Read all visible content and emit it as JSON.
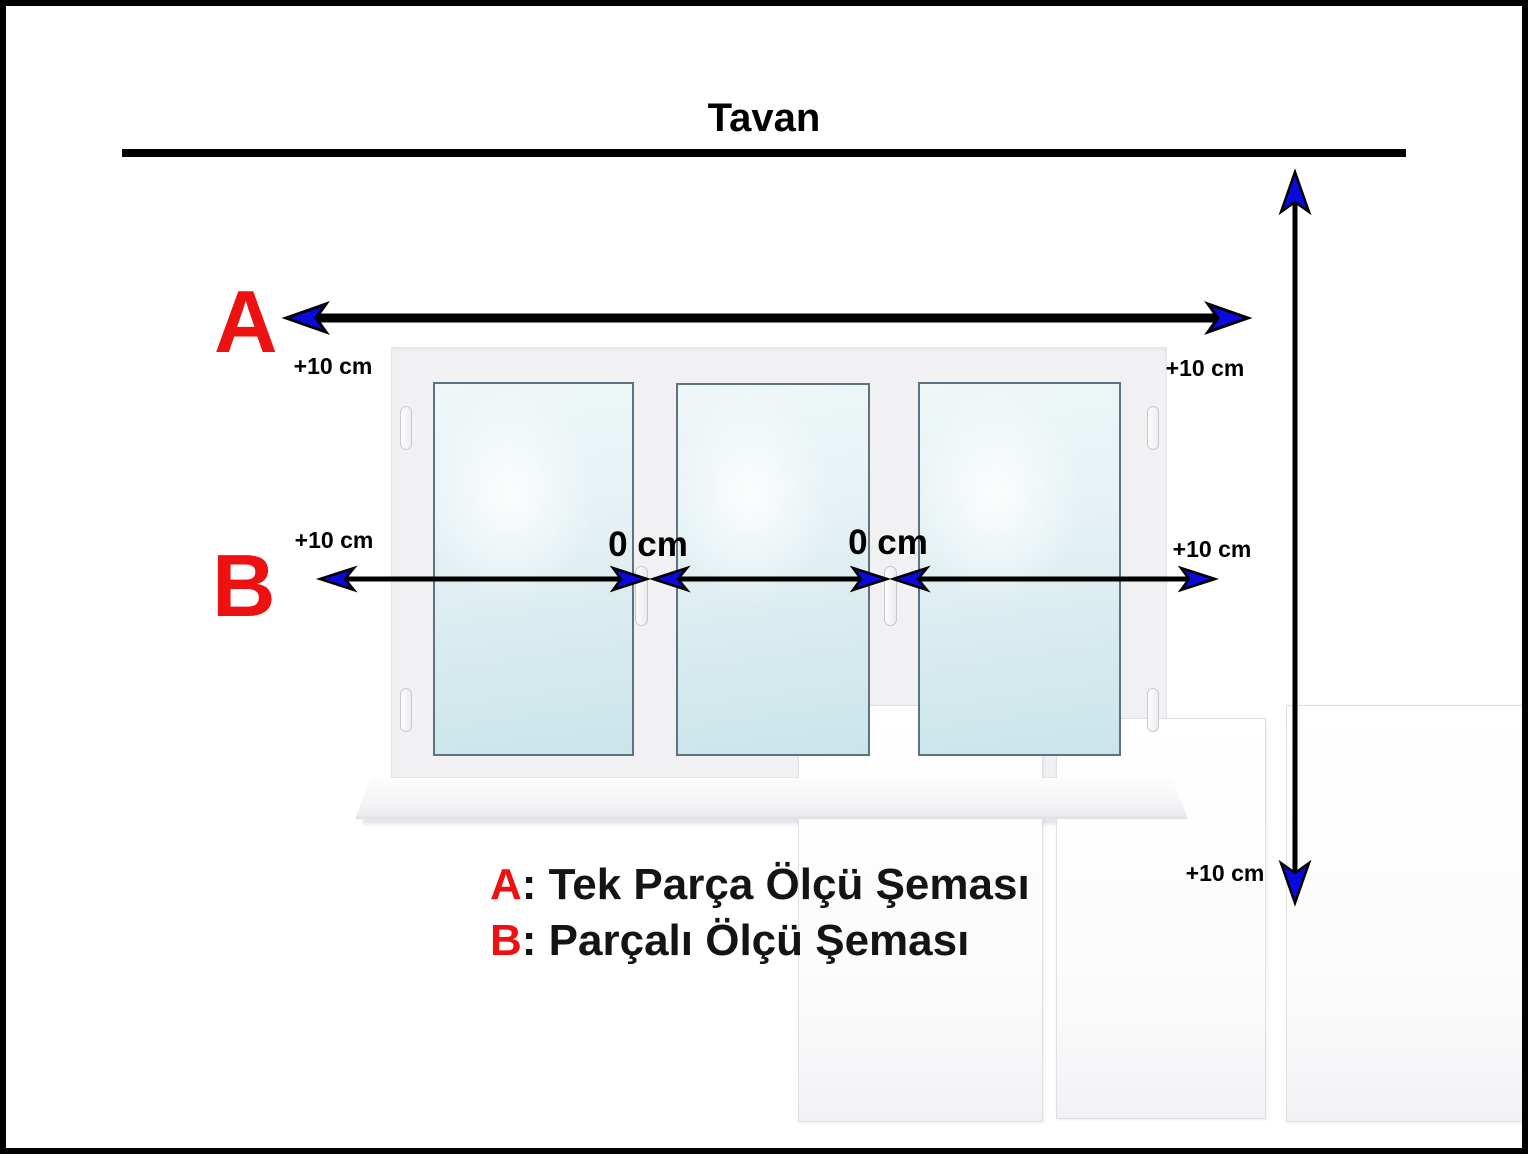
{
  "title": "Tavan",
  "markers": {
    "a": "A",
    "b": "B"
  },
  "measurements": {
    "a_left": "+10 cm",
    "a_right": "+10 cm",
    "b_left": "+10 cm",
    "b_right": "+10 cm",
    "gap_1": "0 cm",
    "gap_2": "0 cm",
    "height_bottom": "+10 cm"
  },
  "legend": {
    "items": [
      {
        "key": "A",
        "text": ": Tek Parça Ölçü Şeması"
      },
      {
        "key": "B",
        "text": ": Parçalı Ölçü Şeması"
      }
    ]
  },
  "window": {
    "panes": 3
  },
  "colors": {
    "marker_red": "#ee1111",
    "arrow_black": "#000000",
    "arrowhead_blue": "#0a0add",
    "glass_tint": "#cde7ec",
    "frame_gray": "#f1f1f3"
  }
}
